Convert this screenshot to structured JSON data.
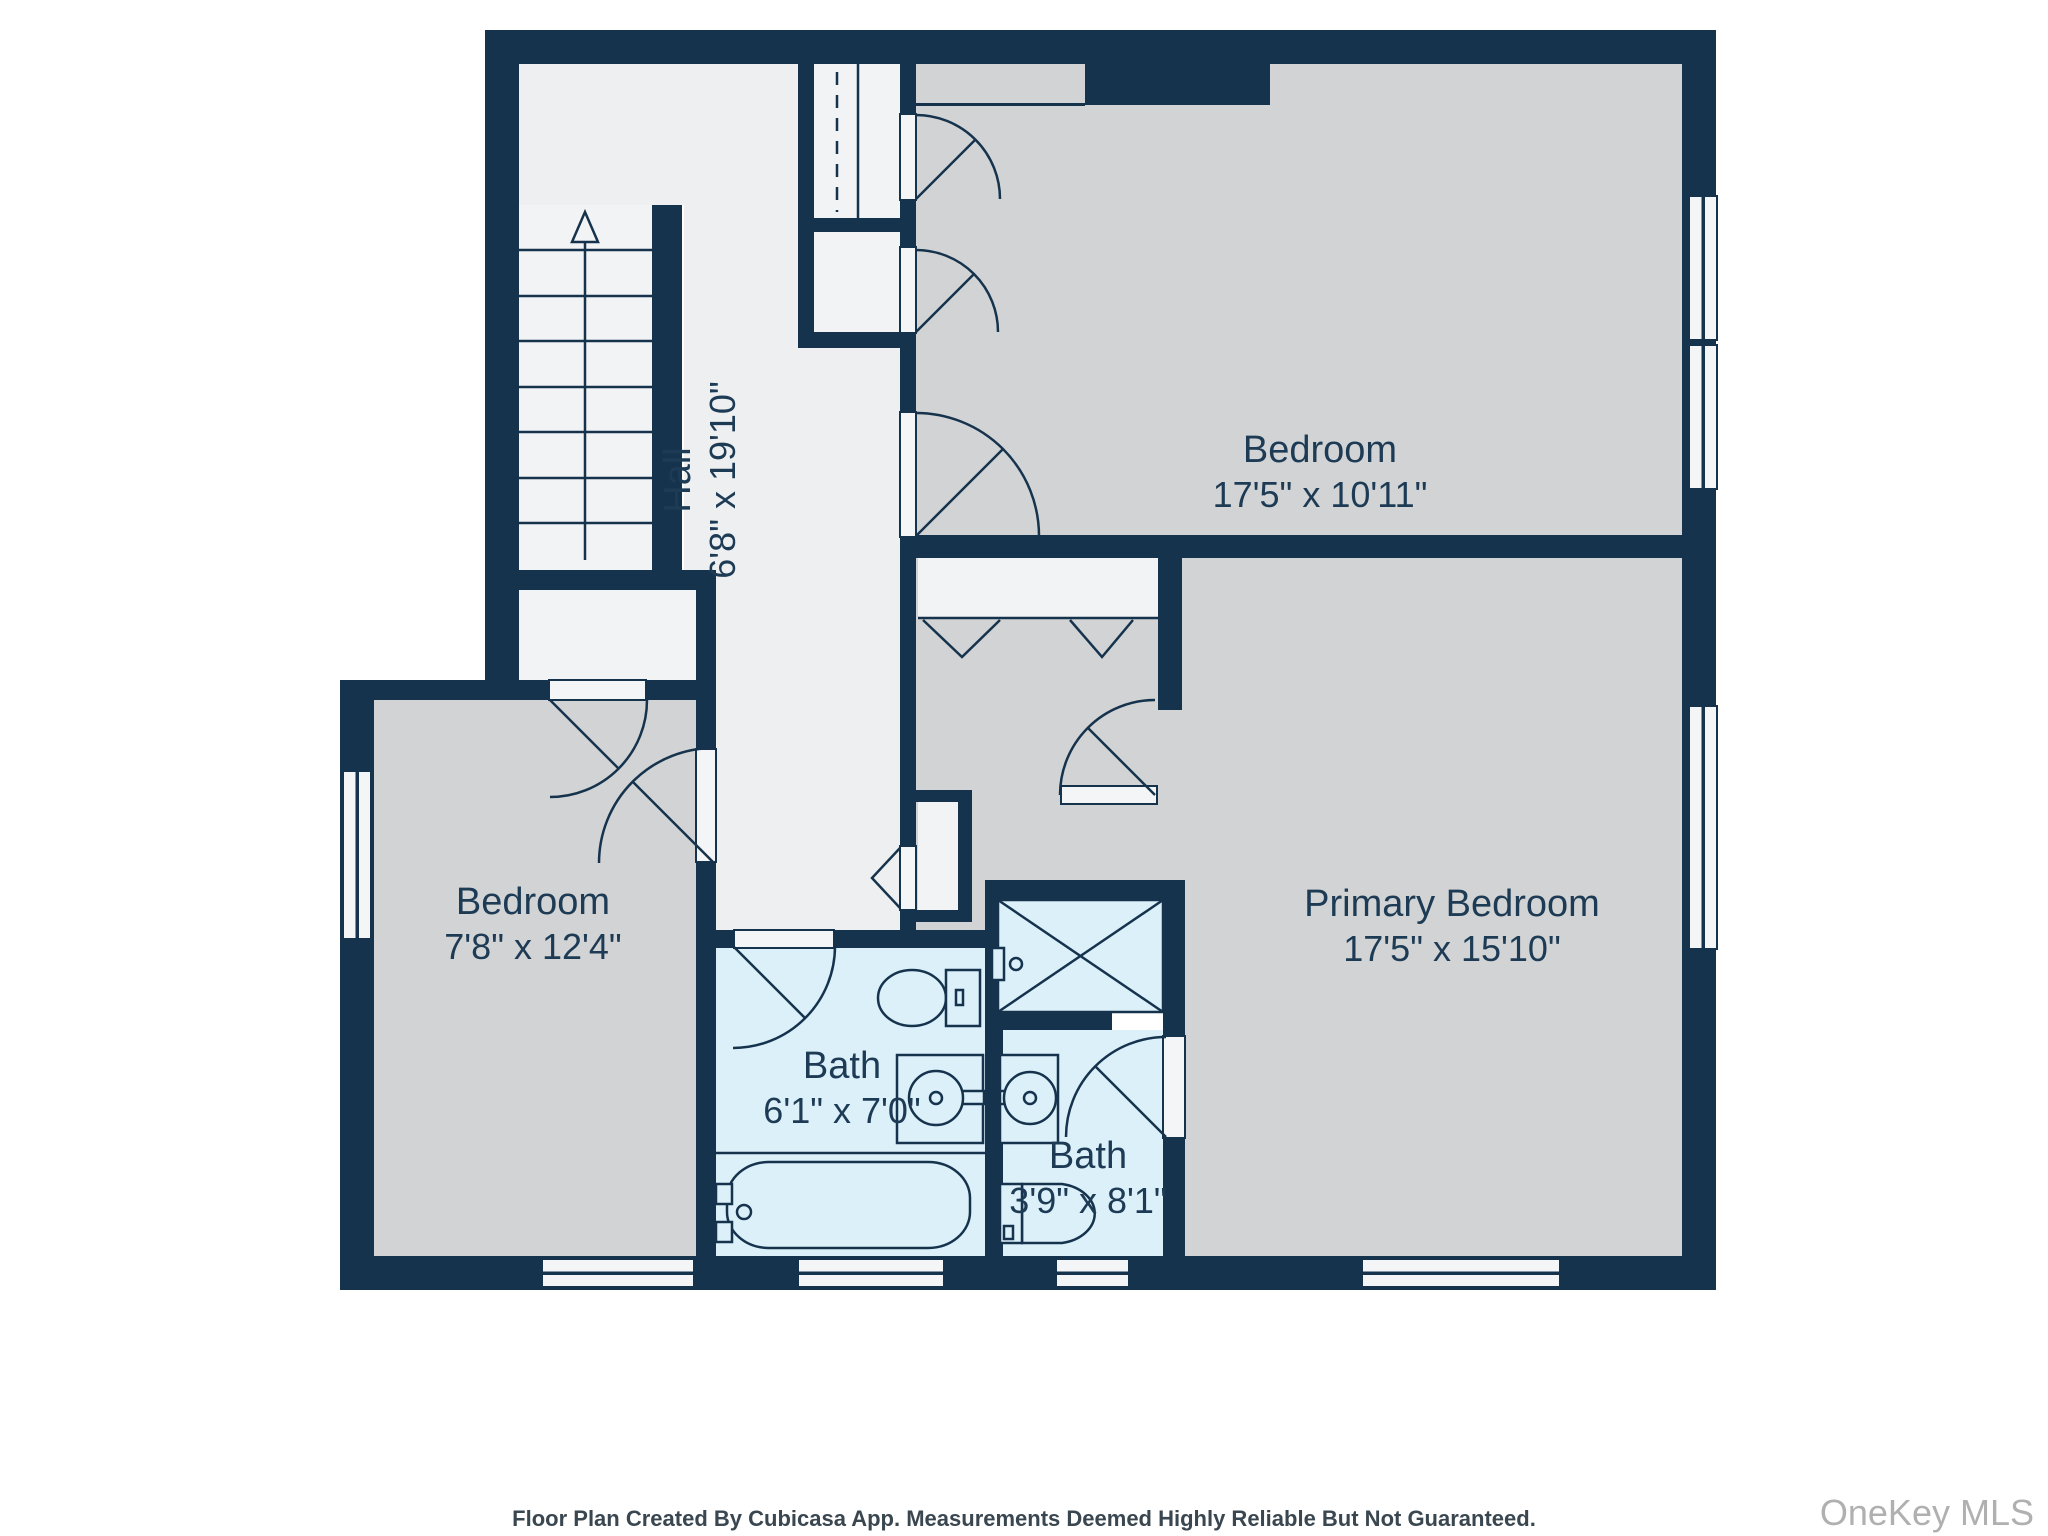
{
  "rooms": {
    "hall": {
      "name": "Hall",
      "dims": "6'8\" x 19'10\""
    },
    "bedroom_top": {
      "name": "Bedroom",
      "dims": "17'5\" x 10'11\""
    },
    "primary_bedroom": {
      "name": "Primary Bedroom",
      "dims": "17'5\" x 15'10\""
    },
    "bedroom_left": {
      "name": "Bedroom",
      "dims": "7'8\" x 12'4\""
    },
    "bath_main": {
      "name": "Bath",
      "dims": "6'1\" x 7'0\""
    },
    "bath_ensuite": {
      "name": "Bath",
      "dims": "3'9\" x 8'1\""
    }
  },
  "footer": {
    "disclaimer": "Floor Plan Created By Cubicasa App. Measurements Deemed Highly Reliable But Not Guaranteed."
  },
  "watermark": {
    "text": "OneKey MLS"
  },
  "colors": {
    "wall": "#16334D",
    "room_gray": "#D2D3D4",
    "hall_light": "#EDEFF0",
    "closet_light": "#F2F3F4",
    "bath_blue": "#DCF0FA",
    "label_text": "#1D3B55",
    "watermark_text": "#B0B0B1"
  }
}
